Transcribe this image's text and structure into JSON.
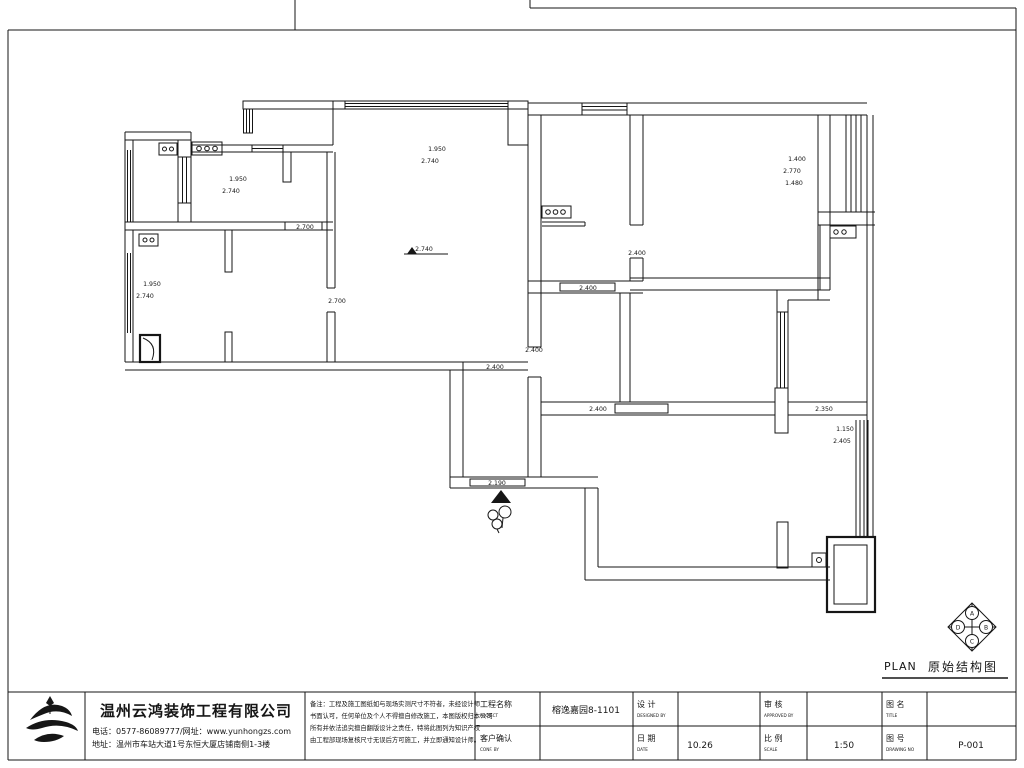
{
  "sheet": {
    "plan_caption_en": "PLAN",
    "plan_caption_zh": "原始结构图",
    "compass": {
      "top": "A",
      "right": "B",
      "bottom": "C",
      "left": "D"
    }
  },
  "plan": {
    "dims": [
      "1.950",
      "2.740",
      "1.950",
      "2.740",
      "1.950",
      "2.740",
      "2.740",
      "1.400",
      "2.770",
      "1.480",
      "2.400",
      "2.400",
      "2.400",
      "2.400",
      "2.190",
      "2.400",
      "2.350",
      "1.150",
      "2.405",
      "2.700",
      "2.700"
    ]
  },
  "title_block": {
    "company_name": "温州云鸿装饰工程有限公司",
    "company_phone": "电话：0577-86089777/网址：www.yunhongzs.com",
    "company_address": "地址：温州市车站大道1号东恒大厦店铺南侧1-3楼",
    "notes": {
      "line1": "备注：工程及施工图纸如与现场实测尺寸不符者，未经设计师",
      "line2": "书面认可，任何单位及个人不得擅自修改施工，本图版权归本公司",
      "line3": "所有并依法追究擅自翻版设计之责任，特将此图列为知识产权",
      "line4": "由工程部现场复核尺寸无误后方可施工，并立即通知设计师。"
    },
    "fields": {
      "project_label": "工程名称",
      "project_label_en": "PROJECT",
      "project_value": "榕逸嘉园8-1101",
      "confirm_label": "客户确认",
      "confirm_label_en": "CONF. BY",
      "confirm_value": "",
      "design_label": "设  计",
      "design_label_en": "DESIGNED BY",
      "design_value": "",
      "date_label": "日  期",
      "date_label_en": "DATE",
      "date_value": "10.26",
      "approve_label": "审  核",
      "approve_label_en": "APPROVED BY",
      "approve_value": "",
      "scale_label": "比  例",
      "scale_label_en": "SCALE",
      "scale_value": "1:50",
      "title_label": "图  名",
      "title_label_en": "TITLE",
      "title_value": "",
      "number_label": "图  号",
      "number_label_en": "DRAWING NO",
      "number_value": "P-001"
    }
  }
}
